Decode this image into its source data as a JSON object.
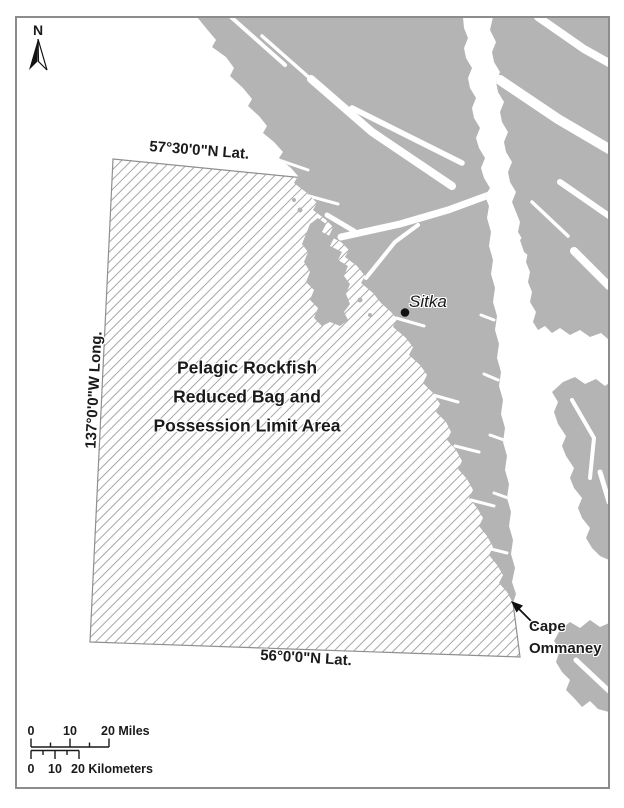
{
  "map": {
    "north_label": "N",
    "coordinates": {
      "top_lat": "57°30'0\"N Lat.",
      "left_long": "137°0'0\"W Long.",
      "bottom_lat": "56°0'0\"N Lat."
    },
    "area_label": [
      "Pelagic Rockfish",
      "Reduced Bag and",
      "Possession Limit Area"
    ],
    "places": {
      "sitka": "Sitka",
      "cape": [
        "Cape",
        "Ommaney"
      ]
    },
    "colors": {
      "land": "#b4b4b4",
      "water": "#ffffff",
      "hatch_line": "#a6a6a6",
      "hatch_outline": "#8f8f8f",
      "frame_border": "#8c8c8c",
      "text": "#1a1a1a"
    }
  },
  "scalebar": {
    "miles_labels": [
      "0",
      "10",
      "20 Miles"
    ],
    "km_labels": [
      "0",
      "10",
      "20 Kilometers"
    ]
  }
}
